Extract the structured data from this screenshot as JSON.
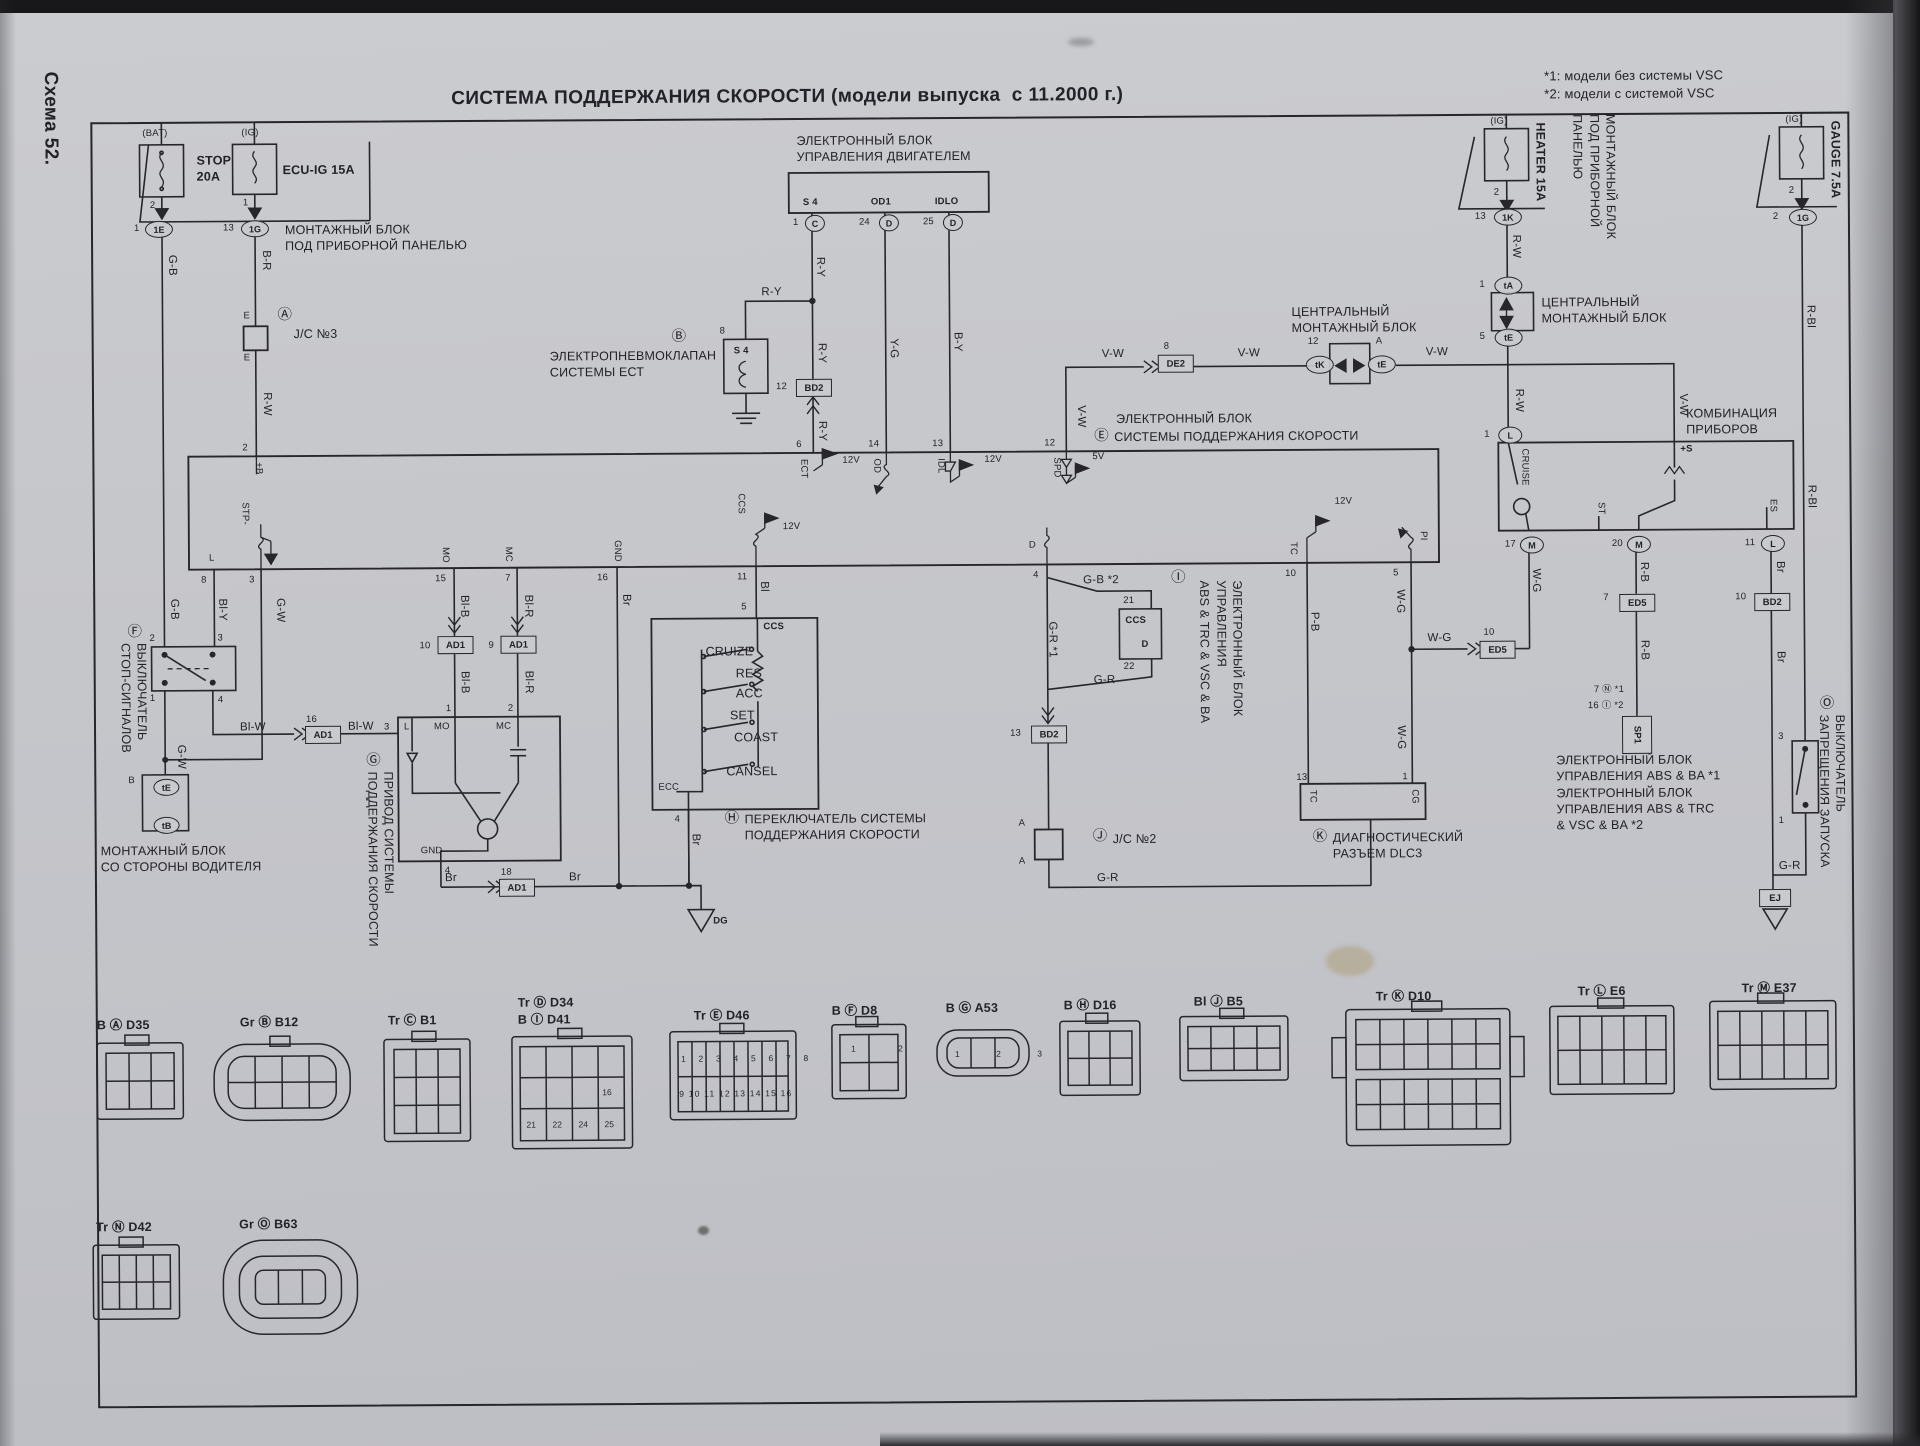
{
  "page": {
    "scheme": "Схема 52.",
    "title": "СИСТЕМА ПОДДЕРЖАНИЯ СКОРОСТИ (модели выпуска  с 11.2000 г.)",
    "note1": "*1: модели без системы VSC",
    "note2": "*2: модели с системой VSC"
  },
  "wires": {
    "gb": "G-B",
    "brr": "B-R",
    "rw": "R-W",
    "ry": "R-Y",
    "yg": "Y-G",
    "by": "B-Y",
    "vw": "V-W",
    "gw": "G-W",
    "bly": "Bl-Y",
    "blw": "Bl-W",
    "blb": "Bl-B",
    "blr": "Bl-R",
    "br": "Br",
    "bl": "Bl",
    "gb2": "G-B *2",
    "gr1": "G-R *1",
    "gr": "G-R",
    "pb": "P-B",
    "wg": "W-G",
    "rb": "R-B",
    "rbl": "R-Bl"
  },
  "volt": {
    "v12": "12V",
    "v5": "5V"
  },
  "fuse_stop": {
    "tag": "(BAT)",
    "name": "STOP\n20A",
    "pin": "2",
    "cnum": "1",
    "ccode": "1E"
  },
  "fuse_ecuig": {
    "tag": "(IG)",
    "name": "ECU-IG 15A",
    "pin": "1",
    "cnum": "13",
    "ccode": "1G"
  },
  "fuse_heater": {
    "tag": "(IG)",
    "name": "HEATER 15A",
    "pin": "2",
    "cnum": "13",
    "ccode": "1K"
  },
  "fuse_gauge": {
    "tag": "(IG)",
    "name": "GAUGE 7.5A",
    "pin": "2",
    "cnum": "2",
    "ccode": "1G"
  },
  "jb_panel": {
    "name": "МОНТАЖНЫЙ БЛОК\nПОД ПРИБОРНОЙ ПАНЕЛЬЮ"
  },
  "jb_panel_r": {
    "name": "МОНТАЖНЫЙ БЛОК\nПОД ПРИБОРНОЙ\nПАНЕЛЬЮ"
  },
  "jc3": {
    "callout": "Ⓐ",
    "name": "J/C №3",
    "pin_top": "E",
    "pin_bot": "E"
  },
  "valve": {
    "callout": "Ⓑ",
    "name": "ЭЛЕКТРОПНЕВМОКЛАПАН\nСИСТЕМЫ ЕСТ",
    "code": "S 4",
    "pin": "8"
  },
  "engine_ecu": {
    "name": "ЭЛЕКТРОННЫЙ БЛОК\nУПРАВЛЕНИЯ ДВИГАТЕЛЕМ",
    "t1": "S 4",
    "t2": "OD1",
    "t3": "IDLO",
    "p1": "1",
    "c1": "C",
    "p2": "24",
    "c2": "D",
    "p3": "25",
    "c3": "D"
  },
  "cruise_ecu": {
    "callout": "Ⓔ",
    "l1": "ЭЛЕКТРОННЫЙ БЛОК",
    "l2": "СИСТЕМЫ ПОДДЕРЖАНИЯ СКОРОСТИ",
    "pins": {
      "p2": "2",
      "b": "+B",
      "p6": "6",
      "ect": "ECT",
      "p14": "14",
      "od": "OD",
      "p13": "13",
      "idl": "IDL",
      "p12": "12",
      "spd": "SPD",
      "p8": "8",
      "l": "L",
      "p3": "3",
      "stp": "STP-",
      "p15": "15",
      "mo": "MO",
      "p7": "7",
      "mc": "MC",
      "p16": "16",
      "gnd": "GND",
      "p11": "11",
      "ccs": "CCS",
      "p4": "4",
      "d": "D",
      "p10": "10",
      "tc": "TC",
      "p5": "5",
      "pi": "PI"
    }
  },
  "center_jb": {
    "name": "ЦЕНТРАЛЬНЫЙ\nМОНТАЖНЫЙ БЛОК",
    "n12": "12",
    "tk": "tK",
    "na": "A",
    "te": "tE"
  },
  "right_jb": {
    "name": "ЦЕНТРАЛЬНЫЙ\nМОНТАЖНЫЙ БЛОК",
    "n1": "1",
    "ta": "tA",
    "n5": "5",
    "te": "tE"
  },
  "meter": {
    "name": "КОМБИНАЦИЯ\nПРИБОРОВ",
    "plus_s": "+S",
    "cruise": "CRUISE",
    "st": "ST",
    "es": "ES",
    "n1": "1",
    "l": "L",
    "n17": "17",
    "m": "M",
    "n20": "20",
    "n11": "11"
  },
  "dlc3": {
    "callout": "Ⓚ",
    "name": "ДИАГНОСТИЧЕСКИЙ\nРАЗЪЕМ DLC3",
    "p13": "13",
    "tc": "TC",
    "p1": "1",
    "cg": "CG"
  },
  "abs": {
    "callout": "Ⓘ",
    "vtext": "ЭЛЕКТРОННЫЙ БЛОК\nУПРАВЛЕНИЯ\nABS & TRC & VSC & BA",
    "ccs": "CCS",
    "d": "D",
    "p21": "21",
    "p22": "22",
    "note": "ЭЛЕКТРОННЫЙ БЛОК\nУПРАВЛЕНИЯ ABS & BA *1\nЭЛЕКТРОННЫЙ БЛОК\nУПРАВЛЕНИЯ ABS & TRC\n& VSC & BA *2"
  },
  "jc2": {
    "callout": "Ⓙ",
    "name": "J/C №2",
    "a_top": "A",
    "a_bot": "A"
  },
  "sp1": {
    "code": "SP1",
    "l1": "7 Ⓝ *1",
    "l2": "16 Ⓘ *2"
  },
  "inhibit": {
    "callout": "Ⓞ",
    "vtext": "ВЫКЛЮЧАТЕЛЬ\nЗАПРЕЩЕНИЯ ЗАПУСКА",
    "p_top": "3",
    "p_bot": "1"
  },
  "stop_sw": {
    "callout": "Ⓕ",
    "vtext": "ВЫКЛЮЧАТЕЛЬ\nСТОП-СИГНАЛОВ",
    "p2": "2",
    "p3": "3",
    "p1": "1",
    "p4": "4"
  },
  "driver_jb": {
    "name": "МОНТАЖНЫЙ БЛОК\nСО СТОРОНЫ ВОДИТЕЛЯ",
    "b": "B",
    "te": "tE",
    "tb": "tB"
  },
  "actuator": {
    "callout": "Ⓖ",
    "vtext": "ПРИВОД СИСТЕМЫ\nПОДДЕРЖАНИЯ СКОРОСТИ",
    "l": "L",
    "mo": "MO",
    "mc": "MC",
    "gnd": "GND",
    "p3": "3",
    "p1": "1",
    "p2": "2",
    "p4": "4"
  },
  "control_sw": {
    "callout": "Ⓗ",
    "name": "ПЕРЕКЛЮЧАТЕЛЬ СИСТЕМЫ\nПОДДЕРЖАНИЯ СКОРОСТИ",
    "ccs": "CCS",
    "p5": "5",
    "p4": "4",
    "cruize": "CRUIZE",
    "res": "RES",
    "acc": "ACC",
    "set": "SET",
    "coast": "COAST",
    "cansel": "CANSEL",
    "ecc": "ECC"
  },
  "conn": {
    "ad1": "AD1",
    "bd2": "BD2",
    "ed5": "ED5",
    "de2": "DE2",
    "n16": "16",
    "n10": "10",
    "n9": "9",
    "n18": "18",
    "n12": "12",
    "n13": "13",
    "n8": "8",
    "n7": "7"
  },
  "grounds": {
    "dg": "DG",
    "ej": "EJ"
  },
  "connectors": [
    {
      "label": "B Ⓐ D35"
    },
    {
      "label": "Gr Ⓑ B12"
    },
    {
      "label": "Tr Ⓒ B1"
    },
    {
      "label": "Tr Ⓓ D34",
      "label2": "B Ⓘ D41",
      "c1": "21",
      "c2": "22",
      "c3": "24",
      "c4": "25",
      "c5": "16"
    },
    {
      "label": "Tr Ⓔ D46",
      "row1": "1 2 3 4 5 6 7 8",
      "row2": "9 10 11 12 13 14 15 16"
    },
    {
      "label": "B Ⓕ D8",
      "cells": "1 2"
    },
    {
      "label": "B Ⓖ A53",
      "cells": "1 2 3"
    },
    {
      "label": "B Ⓗ D16"
    },
    {
      "label": "Bl Ⓙ B5"
    },
    {
      "label": "Tr Ⓚ D10"
    },
    {
      "label": "Tr Ⓛ E6"
    },
    {
      "label": "Tr Ⓜ E37"
    },
    {
      "label": "Tr Ⓝ D42"
    },
    {
      "label": "Gr Ⓞ B63"
    }
  ]
}
